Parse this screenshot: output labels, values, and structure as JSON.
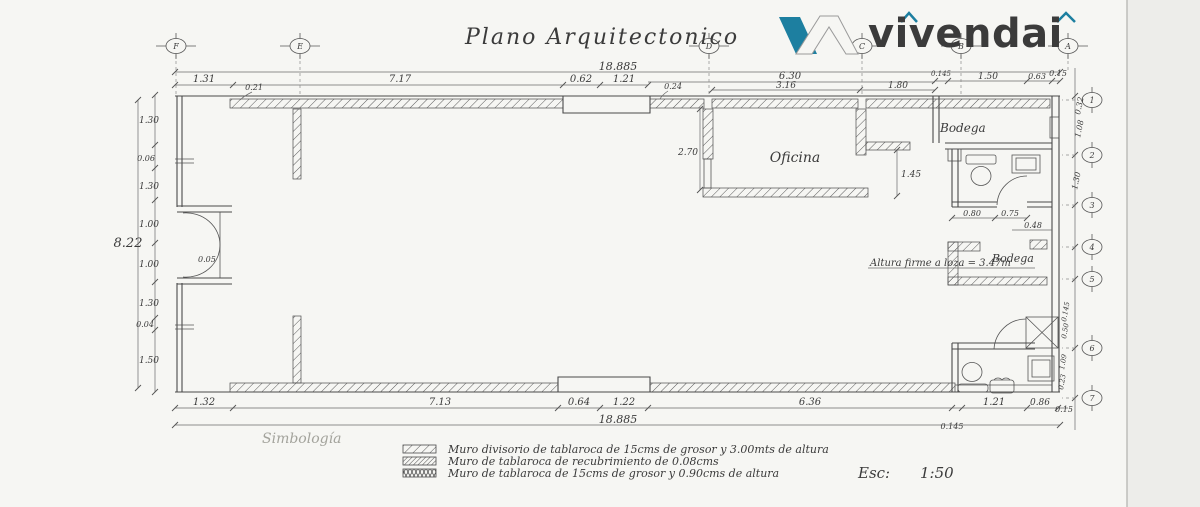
{
  "page": {
    "title": "Plano Arquitectonico"
  },
  "logo": {
    "brand": "vivendai"
  },
  "colors": {
    "brand_teal": "#1d7fa0",
    "ink": "#3b3b3b",
    "paper": "#f6f6f3"
  },
  "grid_markers": {
    "top": [
      "F",
      "E",
      "D",
      "C",
      "B",
      "A"
    ],
    "right": [
      "1",
      "2",
      "3",
      "4",
      "5",
      "6",
      "7"
    ]
  },
  "rooms": {
    "oficina": "Oficina",
    "bodega_top": "Bodega",
    "bodega_mid": "Bodega"
  },
  "annotations": {
    "altura_note": "Altura firme a loza = 3.47m",
    "door_dim": "0.05"
  },
  "dims": {
    "top_total": "18.885",
    "bottom_total": "18.885",
    "left_total": "8.22",
    "top": [
      "1.31",
      "0.21",
      "7.17",
      "0.62",
      "1.21",
      "0.24",
      "3.16",
      "6.30",
      "1.80"
    ],
    "top_right": [
      "0.145",
      "1.50",
      "0.63",
      "0.15"
    ],
    "bottom": [
      "1.32",
      "7.13",
      "0.64",
      "1.22",
      "6.36"
    ],
    "bottom_right": [
      "0.145",
      "1.21",
      "0.86",
      "0.15"
    ],
    "left": [
      "1.30",
      "0.06",
      "1.30",
      "1.00",
      "1.00",
      "1.30",
      "0.04",
      "1.50"
    ],
    "right": [
      "0.32",
      "1.08",
      "1.30",
      "0.145",
      "0.50",
      "1.09",
      "0.23"
    ],
    "oficina": [
      "2.70",
      "1.45"
    ],
    "bath": [
      "0.80",
      "0.75",
      "0.48"
    ]
  },
  "legend": {
    "heading": "Simbología",
    "items": [
      "Muro divisorio de tablaroca de 15cms de grosor y 3.00mts de altura",
      "Muro de tablaroca de recubrimiento de 0.08cms",
      "Muro de tablaroca de 15cms de grosor y 0.90cms de altura"
    ]
  },
  "scale": {
    "label": "Esc:",
    "value": "1:50"
  }
}
